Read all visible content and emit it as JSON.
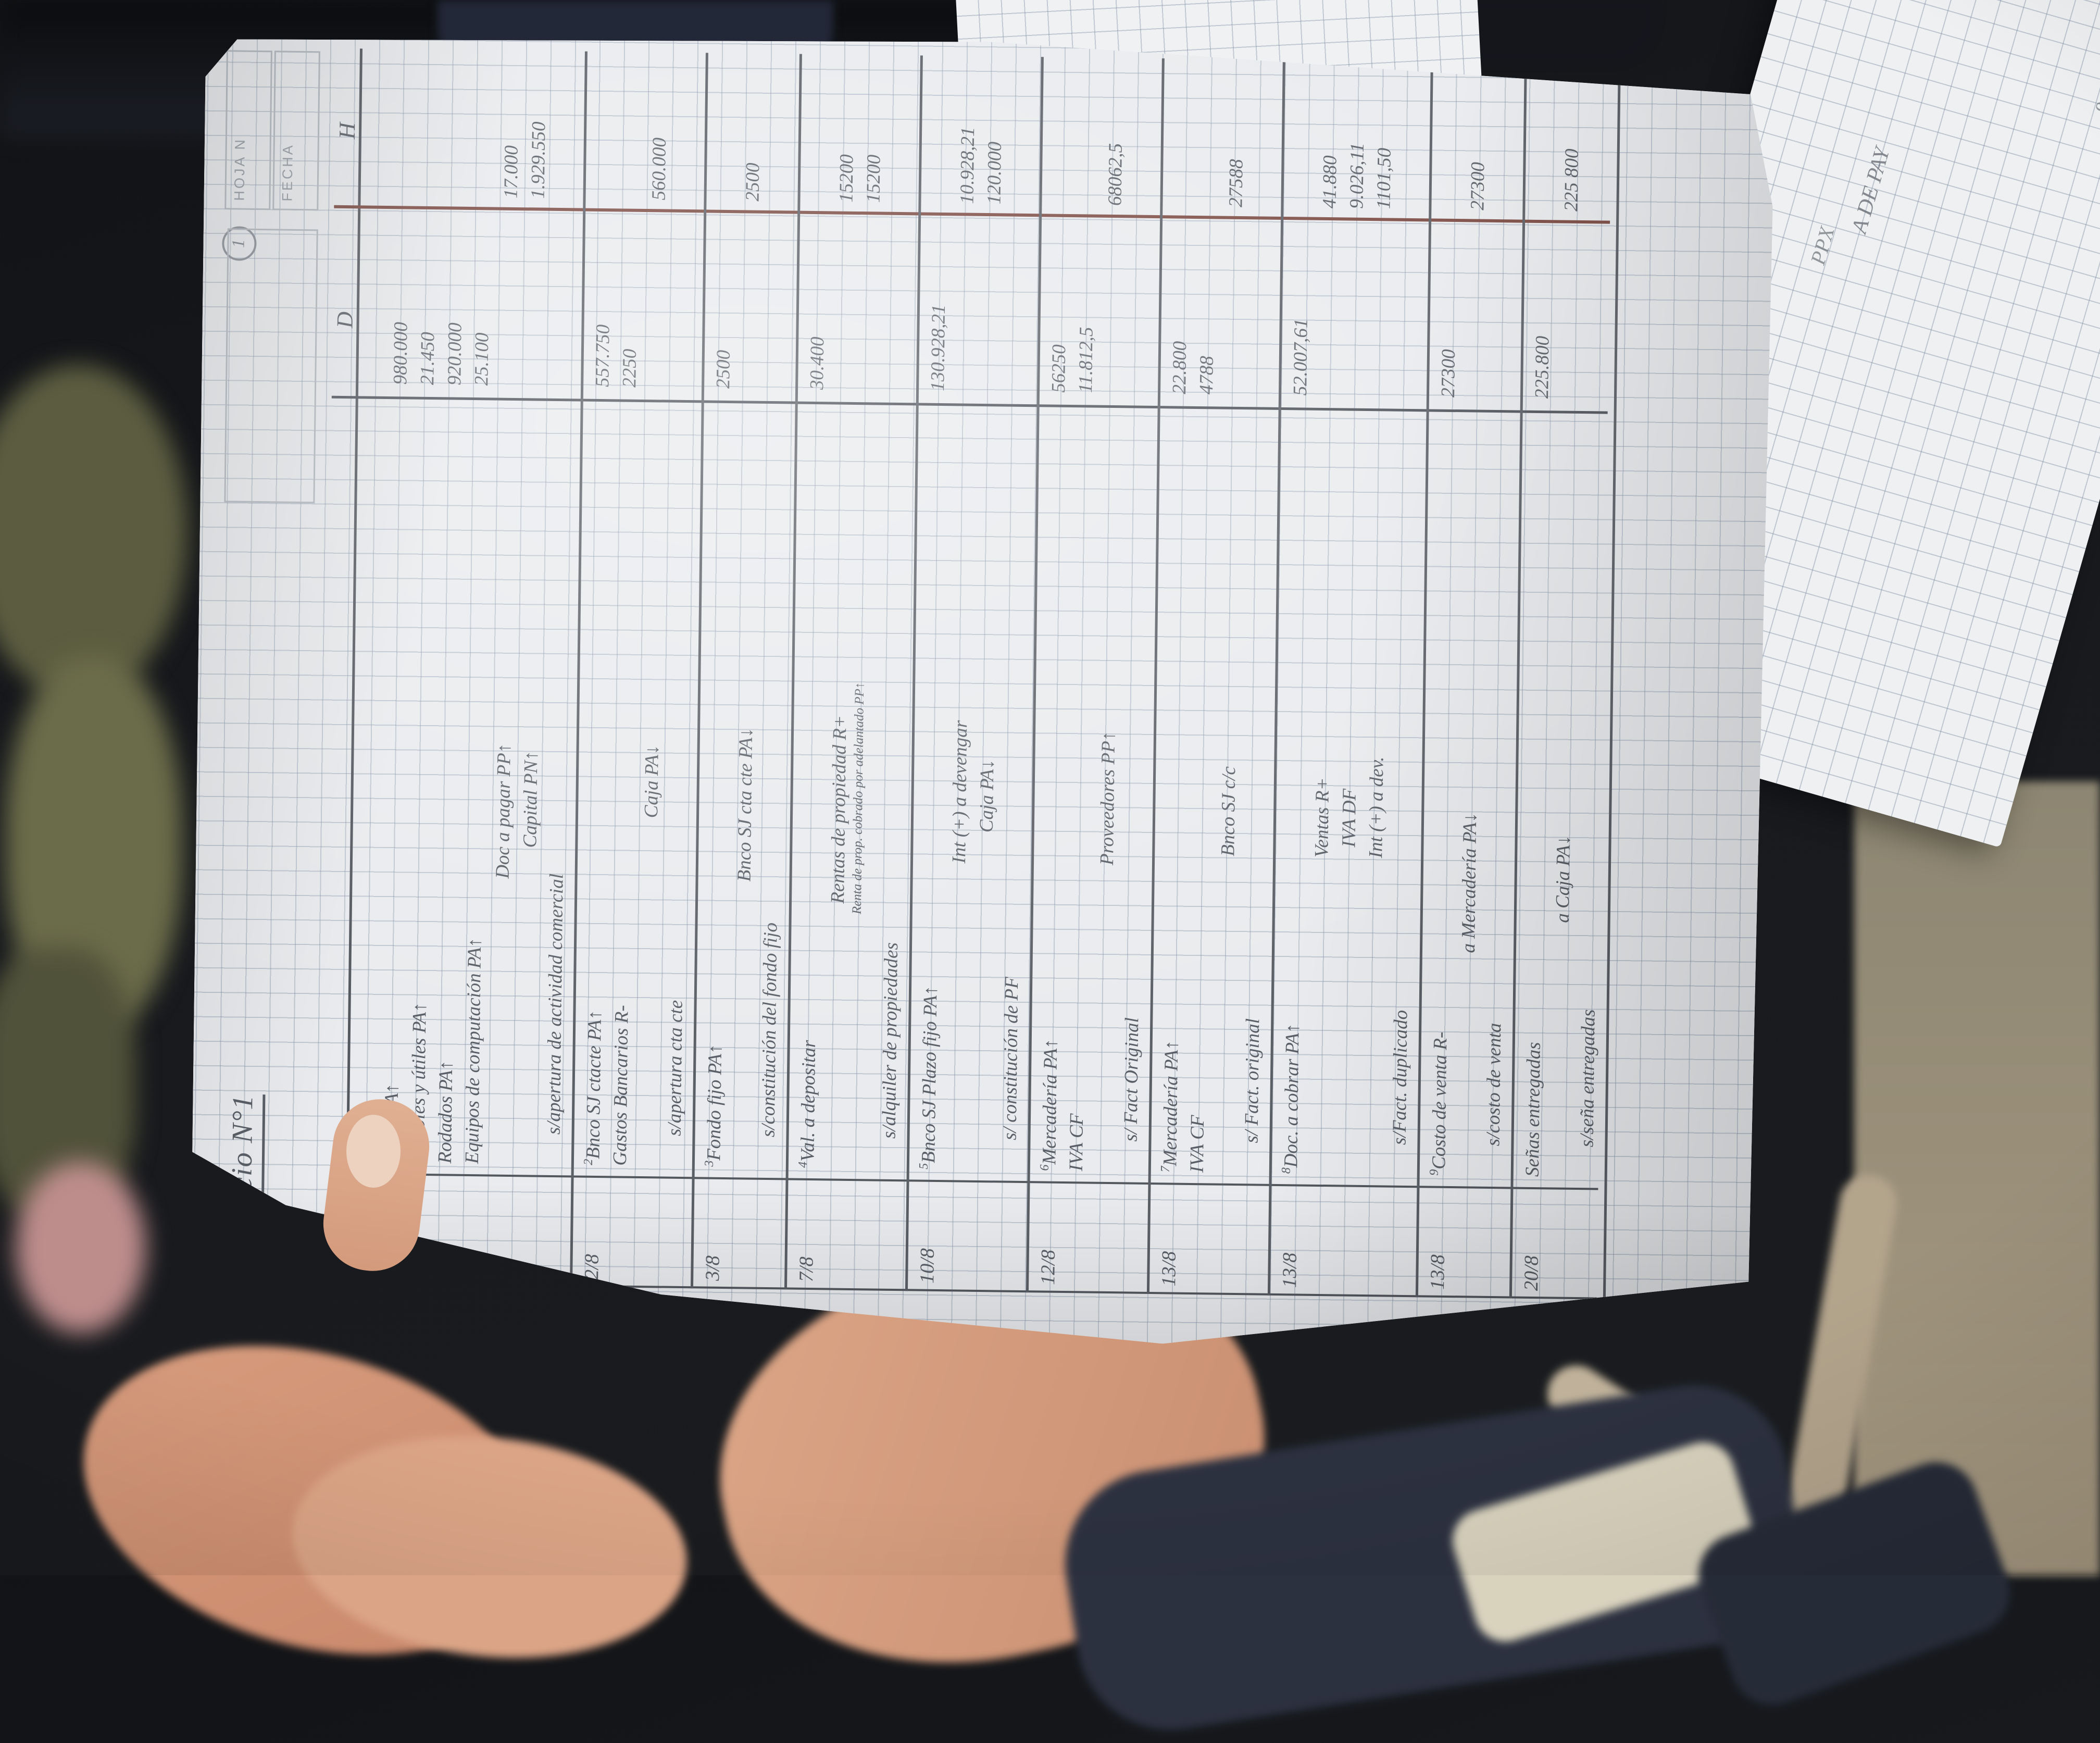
{
  "page": {
    "page_number_circle": "1",
    "title": "EJercicio N°1",
    "printed": {
      "hoja": "HOJA N",
      "fecha": "FECHA",
      "nota": "NOTA"
    },
    "table": {
      "fecha_header": "Fecha",
      "debit_header": "D",
      "credit_header": "H"
    },
    "colors": {
      "pencil": "#5a5f67",
      "margin_line": "#7b4a42",
      "paper": "#e9ebee"
    }
  },
  "journal": {
    "entries": [
      {
        "n": "1",
        "date": "1/8",
        "lines": [
          {
            "t": "Caja PA↑",
            "role": "debit",
            "d": "980.000"
          },
          {
            "t": "Muebles y útiles PA↑",
            "role": "debit",
            "d": "21.450"
          },
          {
            "t": "Rodados PA↑",
            "role": "debit",
            "d": "920.000"
          },
          {
            "t": "Equipos de computación PA↑",
            "role": "debit",
            "d": "25.100"
          },
          {
            "t": "Doc a pagar PP↑",
            "role": "credit",
            "h": "17.000",
            "ind": 560
          },
          {
            "t": "Capital PN↑",
            "role": "credit",
            "h": "1.929.550",
            "ind": 620
          },
          {
            "t": "s/apertura de actividad comercial",
            "role": "memo"
          }
        ]
      },
      {
        "n": "2",
        "date": "2/8",
        "lines": [
          {
            "t": "Bnco SJ ctacte PA↑",
            "role": "debit",
            "d": "557.750"
          },
          {
            "t": "Gastos Bancarios R-",
            "role": "debit",
            "d": "2250"
          },
          {
            "t": "Caja PA↓",
            "role": "credit",
            "h": "560.000",
            "ind": 680
          },
          {
            "t": "s/apertura cta cte",
            "role": "memo"
          }
        ]
      },
      {
        "n": "3",
        "date": "3/8",
        "lines": [
          {
            "t": "Fondo fijo PA↑",
            "role": "debit",
            "d": "2500"
          },
          {
            "t": "Bnco SJ cta cte PA↓",
            "role": "credit",
            "h": "2500",
            "ind": 560
          },
          {
            "t": "s/constitución del fondo fijo",
            "role": "memo"
          }
        ]
      },
      {
        "n": "4",
        "date": "7/8",
        "lines": [
          {
            "t": "Val. a depositar",
            "role": "debit",
            "d": "30.400"
          },
          {
            "t": "Rentas de propiedad R+",
            "role": "credit",
            "h": "15200",
            "ind": 520
          },
          {
            "t": "Renta de prop. cobrado por adelantado PP↑",
            "role": "credit",
            "h": "15200",
            "ind": 500,
            "small": true
          },
          {
            "t": "s/alquiler de propiedades",
            "role": "memo"
          }
        ]
      },
      {
        "n": "5",
        "date": "10/8",
        "lines": [
          {
            "t": "Bnco SJ Plazo fijo PA↑",
            "role": "debit",
            "d": "130.928,21"
          },
          {
            "t": "Int (+) a devengar",
            "role": "credit",
            "h": "10.928,21",
            "ind": 600
          },
          {
            "t": "Caja PA↓",
            "role": "credit",
            "h": "120.000",
            "ind": 660
          },
          {
            "t": "s/ constitución de PF",
            "role": "memo"
          }
        ]
      },
      {
        "n": "6",
        "date": "12/8",
        "lines": [
          {
            "t": "Mercadería PA↑",
            "role": "debit",
            "d": "56250"
          },
          {
            "t": "IVA CF",
            "role": "debit",
            "d": "11.812,5"
          },
          {
            "t": "Proveedores PP↑",
            "role": "credit",
            "h": "68062,5",
            "ind": 600
          },
          {
            "t": "s/ Fact Original",
            "role": "memo"
          }
        ]
      },
      {
        "n": "7",
        "date": "13/8",
        "lines": [
          {
            "t": "Mercadería PA↑",
            "role": "debit",
            "d": "22.800"
          },
          {
            "t": "IVA CF",
            "role": "debit",
            "d": "4788"
          },
          {
            "t": "Bnco SJ c/c",
            "role": "credit",
            "h": "27588",
            "ind": 620
          },
          {
            "t": "s/ Fact. original",
            "role": "memo"
          }
        ]
      },
      {
        "n": "8",
        "date": "13/8",
        "lines": [
          {
            "t": "Doc. a cobrar PA↑",
            "role": "debit",
            "d": "52.007,61"
          },
          {
            "t": "Ventas R+",
            "role": "credit",
            "h": "41.880",
            "ind": 620
          },
          {
            "t": "IVA DF",
            "role": "credit",
            "h": "9.026,11",
            "ind": 640
          },
          {
            "t": "Int (+) a dev.",
            "role": "credit",
            "h": "1101,50",
            "ind": 620
          },
          {
            "t": "s/Fact. duplicado",
            "role": "memo"
          }
        ]
      },
      {
        "n": "9",
        "date": "13/8",
        "lines": [
          {
            "t": "Costo de venta R-",
            "role": "debit",
            "d": "27300"
          },
          {
            "t": "a Mercadería PA↓",
            "role": "credit",
            "h": "27300",
            "ind": 440
          },
          {
            "t": "s/costo de venta",
            "role": "memo"
          }
        ]
      },
      {
        "n": "",
        "date": "20/8",
        "lines": [
          {
            "t": "Señas entregadas",
            "role": "debit",
            "d": "225.800"
          },
          {
            "t": "a Caja PA↓",
            "role": "credit",
            "h": "225 800",
            "ind": 500
          },
          {
            "t": "s/seña entregadas",
            "role": "memo"
          }
        ]
      }
    ]
  },
  "background": {
    "sheet2_scribbles": [
      "38.000",
      "9.000",
      "A DE PAY",
      "PPX"
    ]
  }
}
